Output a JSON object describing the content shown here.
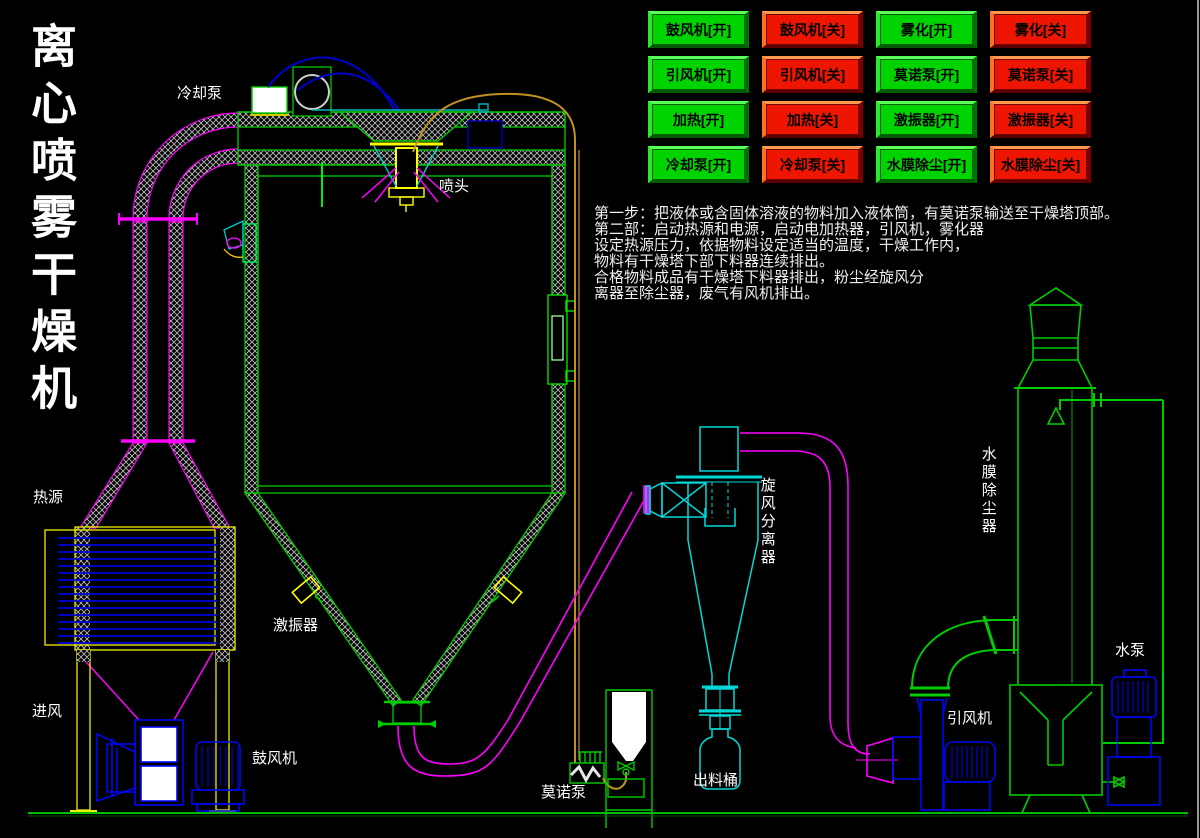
{
  "app": {
    "title": "离心喷雾干燥机"
  },
  "control_panel": {
    "buttons": [
      {
        "label": "鼓风机[开]",
        "state": "on"
      },
      {
        "label": "鼓风机[关]",
        "state": "off"
      },
      {
        "label": "雾化[开]",
        "state": "on"
      },
      {
        "label": "雾化[关]",
        "state": "off"
      },
      {
        "label": "引风机[开]",
        "state": "on"
      },
      {
        "label": "引风机[关]",
        "state": "off"
      },
      {
        "label": "莫诺泵[开]",
        "state": "on"
      },
      {
        "label": "莫诺泵[关]",
        "state": "off"
      },
      {
        "label": "加热[开]",
        "state": "on"
      },
      {
        "label": "加热[关]",
        "state": "off"
      },
      {
        "label": "激振器[开]",
        "state": "on"
      },
      {
        "label": "激振器[关]",
        "state": "off"
      },
      {
        "label": "冷却泵[开]",
        "state": "on"
      },
      {
        "label": "冷却泵[关]",
        "state": "off"
      },
      {
        "label": "水膜除尘[开]",
        "state": "on"
      },
      {
        "label": "水膜除尘[关]",
        "state": "off"
      }
    ]
  },
  "instructions": {
    "lines": [
      "第一步：把液体或含固体溶液的物料加入液体筒，有莫诺泵输送至干燥塔顶部。",
      "第二部：启动热源和电源，启动电加热器，引风机，雾化器",
      "设定热源压力，依据物料设定适当的温度，干燥工作内，",
      "物料有干燥塔下部下料器连续排出。",
      "合格物料成品有干燥塔下料器排出，粉尘经旋风分",
      "离器至除尘器，废气有风机排出。"
    ]
  },
  "diagram": {
    "labels": {
      "cooling_pump": "冷却泵",
      "spray_head": "喷头",
      "heat_source": "热源",
      "air_inlet": "进风",
      "blower": "鼓风机",
      "vibrator": "激振器",
      "mono_pump": "莫诺泵",
      "discharge_barrel": "出料桶",
      "cyclone_separator": "旋风分离器",
      "water_film_dust_remover": "水膜除尘器",
      "induced_draft_fan": "引风机",
      "water_pump": "水泵"
    }
  },
  "colors": {
    "background": "#000000",
    "button_on": "#00d400",
    "button_off": "#ee1600",
    "equipment_green": "#00cc00",
    "equipment_cyan": "#00d8d8",
    "equipment_blue": "#0008ee",
    "equipment_yellow": "#efef00",
    "pipe_magenta": "#ff00ff",
    "pipe_orange": "#c09020",
    "pipe_dark_blue": "#0000cc",
    "text_white": "#ffffff"
  }
}
